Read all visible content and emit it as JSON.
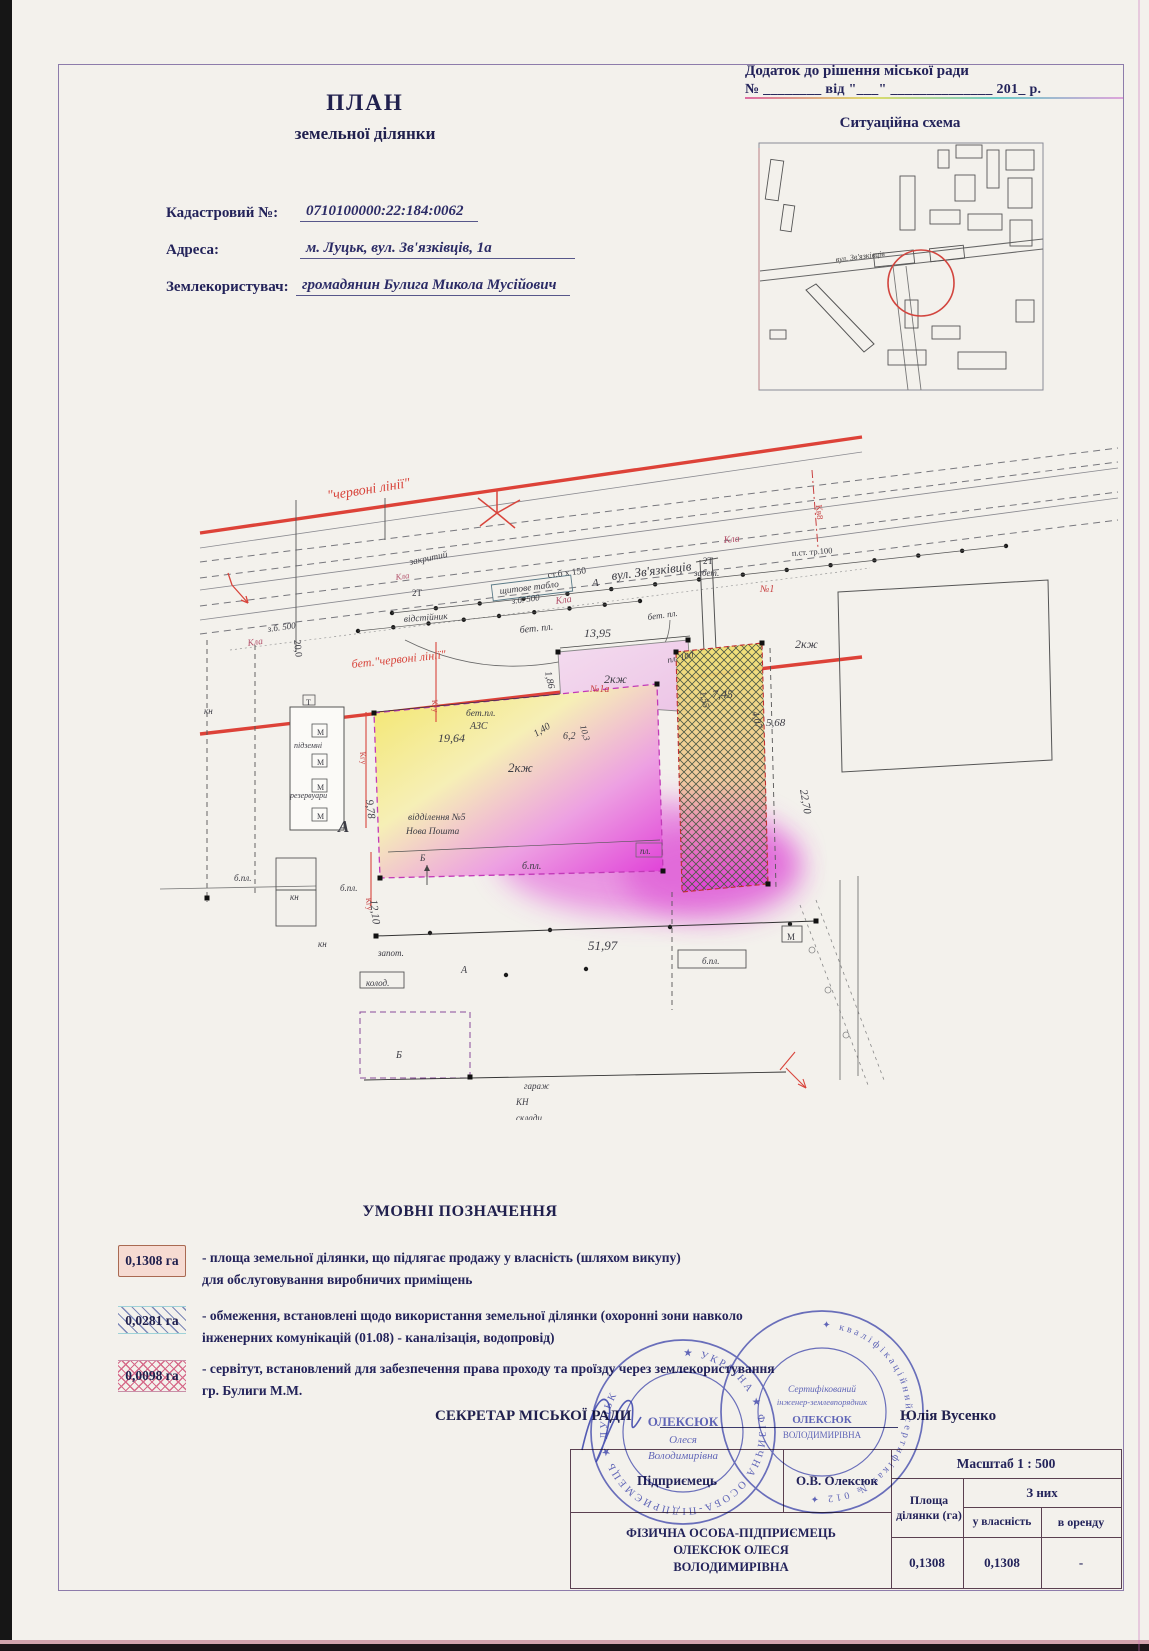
{
  "colors": {
    "red_line": "#dd4238",
    "magenta": "#e03ed8",
    "yellow": "#f3e66a",
    "stamp_blue": "#4a52bc",
    "navy_text": "#23235a"
  },
  "header": {
    "line1": "Додаток до рішення міської ради",
    "line2": "№ ________ від \"___\" ______________ 201_ р."
  },
  "situation": {
    "title": "Ситуаційна схема",
    "street": "вул. Зв'язківців"
  },
  "doc_title": {
    "line1": "ПЛАН",
    "line2": "земельної ділянки"
  },
  "fields": [
    {
      "label": "Кадастровий №:",
      "value": "0710100000:22:184:0062"
    },
    {
      "label": "Адреса:",
      "value": "м. Луцьк, вул. Зв'язківців, 1а"
    },
    {
      "label": "Землекористувач:",
      "value": "громадянин Булига Микола  Мусійович"
    }
  ],
  "plan": {
    "labels": [
      {
        "t": "\"червоні лінії\"",
        "x": 328,
        "y": 500,
        "s": 14,
        "c": "#d8453c",
        "r": -9,
        "i": true
      },
      {
        "t": "бет.\"червоні лінії\"",
        "x": 352,
        "y": 668,
        "s": 12,
        "c": "#d8453c",
        "r": -6,
        "i": true
      },
      {
        "t": "А",
        "x": 592,
        "y": 586,
        "s": 11,
        "i": true
      },
      {
        "t": "вул.  Зв'язківців",
        "x": 612,
        "y": 580,
        "s": 13,
        "r": -7,
        "i": true
      },
      {
        "t": "з.б. 500",
        "x": 268,
        "y": 632,
        "s": 9,
        "r": -8,
        "i": true
      },
      {
        "t": "Кла",
        "x": 248,
        "y": 646,
        "s": 9.5,
        "c": "#b2506a",
        "r": -8,
        "i": true
      },
      {
        "t": "з.б. 500",
        "x": 512,
        "y": 604,
        "s": 9,
        "r": -8,
        "i": true
      },
      {
        "t": "Кла",
        "x": 556,
        "y": 604,
        "s": 10,
        "c": "#b2506a",
        "r": -8,
        "i": true
      },
      {
        "t": "Кла",
        "x": 724,
        "y": 543,
        "s": 10,
        "c": "#b2506a",
        "r": -6,
        "i": true
      },
      {
        "t": "ст.б х 150",
        "x": 548,
        "y": 578,
        "s": 9.5,
        "r": -7
      },
      {
        "t": "закритий",
        "x": 410,
        "y": 565,
        "s": 9.5,
        "r": -12,
        "i": true
      },
      {
        "t": "Кла",
        "x": 396,
        "y": 580,
        "s": 8.5,
        "c": "#b2506a",
        "r": -8,
        "i": true
      },
      {
        "t": "2Т",
        "x": 412,
        "y": 596,
        "s": 9
      },
      {
        "t": "2Т",
        "x": 703,
        "y": 564,
        "s": 9
      },
      {
        "t": "забет.",
        "x": 694,
        "y": 576,
        "s": 9,
        "i": true
      },
      {
        "t": "щитове табло",
        "x": 500,
        "y": 594,
        "s": 9.5,
        "r": -7,
        "i": true
      },
      {
        "t": "відстійник",
        "x": 404,
        "y": 622,
        "s": 9.5,
        "r": -4,
        "i": true
      },
      {
        "t": "п.ст. тр.100",
        "x": 792,
        "y": 556,
        "s": 8.5,
        "r": -4
      },
      {
        "t": "№1",
        "x": 760,
        "y": 592,
        "s": 10,
        "c": "#c84040",
        "i": true
      },
      {
        "t": "Кв8",
        "x": 816,
        "y": 505,
        "s": 9,
        "c": "#c84040",
        "r": 85
      },
      {
        "t": "бет. пл.",
        "x": 520,
        "y": 633,
        "s": 10,
        "r": -6,
        "i": true
      },
      {
        "t": "бет. пл.",
        "x": 648,
        "y": 620,
        "s": 9,
        "r": -8,
        "i": true
      },
      {
        "t": "2кж",
        "x": 795,
        "y": 648,
        "s": 12,
        "i": true
      },
      {
        "t": "пл. 100",
        "x": 668,
        "y": 663,
        "s": 9,
        "r": -12,
        "i": true
      },
      {
        "t": "13,95",
        "x": 584,
        "y": 637,
        "s": 12,
        "i": true
      },
      {
        "t": "1,86",
        "x": 545,
        "y": 672,
        "s": 10,
        "r": 78,
        "i": true
      },
      {
        "t": "№1а",
        "x": 590,
        "y": 692,
        "s": 10,
        "c": "#c84040",
        "i": true
      },
      {
        "t": "2кж",
        "x": 604,
        "y": 683,
        "s": 12,
        "i": true
      },
      {
        "t": "7,45",
        "x": 712,
        "y": 698,
        "s": 12,
        "i": true
      },
      {
        "t": "1,55",
        "x": 700,
        "y": 692,
        "s": 9.5,
        "r": 78,
        "i": true
      },
      {
        "t": "4,07",
        "x": 752,
        "y": 712,
        "s": 10,
        "r": 76,
        "i": true
      },
      {
        "t": "5,68",
        "x": 766,
        "y": 726,
        "s": 11,
        "i": true
      },
      {
        "t": "10,3",
        "x": 580,
        "y": 726,
        "s": 9,
        "r": 74,
        "i": true
      },
      {
        "t": "1,40",
        "x": 536,
        "y": 737,
        "s": 10,
        "r": -32,
        "i": true
      },
      {
        "t": "6,2",
        "x": 563,
        "y": 739,
        "s": 10,
        "i": true
      },
      {
        "t": "19,64",
        "x": 438,
        "y": 742,
        "s": 12,
        "i": true
      },
      {
        "t": "бет.пл.",
        "x": 466,
        "y": 716,
        "s": 9.5,
        "i": true
      },
      {
        "t": "АЗС",
        "x": 470,
        "y": 729,
        "s": 10,
        "i": true
      },
      {
        "t": "2кж",
        "x": 508,
        "y": 772,
        "s": 13,
        "i": true
      },
      {
        "t": "9,78",
        "x": 366,
        "y": 800,
        "s": 11,
        "r": 83,
        "i": true
      },
      {
        "t": "12,10",
        "x": 370,
        "y": 900,
        "s": 11,
        "r": 83,
        "i": true
      },
      {
        "t": "відділення №5",
        "x": 408,
        "y": 820,
        "s": 9.5,
        "i": true
      },
      {
        "t": "Нова Пошта",
        "x": 406,
        "y": 834,
        "s": 9.5,
        "i": true
      },
      {
        "t": "Б",
        "x": 420,
        "y": 861,
        "s": 9,
        "i": true
      },
      {
        "t": "б.пл.",
        "x": 522,
        "y": 869,
        "s": 10,
        "i": true
      },
      {
        "t": "пл.",
        "x": 640,
        "y": 854,
        "s": 9,
        "i": true
      },
      {
        "t": "22,70",
        "x": 800,
        "y": 790,
        "s": 11,
        "r": 80,
        "i": true
      },
      {
        "t": "підземні",
        "x": 294,
        "y": 748,
        "s": 8,
        "i": true
      },
      {
        "t": "резервуари",
        "x": 290,
        "y": 798,
        "s": 8,
        "i": true
      },
      {
        "t": "А",
        "x": 338,
        "y": 832,
        "s": 17,
        "b": true,
        "i": true
      },
      {
        "t": "Т",
        "x": 306,
        "y": 705,
        "s": 8
      },
      {
        "t": "кн",
        "x": 204,
        "y": 714,
        "s": 9,
        "i": true
      },
      {
        "t": "кн",
        "x": 290,
        "y": 900,
        "s": 9,
        "i": true
      },
      {
        "t": "кн",
        "x": 318,
        "y": 947,
        "s": 9,
        "i": true
      },
      {
        "t": "б.пл.",
        "x": 234,
        "y": 881,
        "s": 9,
        "i": true
      },
      {
        "t": "б.пл.",
        "x": 340,
        "y": 891,
        "s": 9,
        "i": true
      },
      {
        "t": "Кгу",
        "x": 360,
        "y": 752,
        "s": 8,
        "c": "#c84040",
        "r": 84
      },
      {
        "t": "Кгу",
        "x": 432,
        "y": 700,
        "s": 8,
        "c": "#c84040",
        "r": 84
      },
      {
        "t": "Кгу",
        "x": 366,
        "y": 898,
        "s": 8,
        "c": "#c84040",
        "r": 84
      },
      {
        "t": "запот.",
        "x": 378,
        "y": 956,
        "s": 9,
        "i": true
      },
      {
        "t": "колод.",
        "x": 366,
        "y": 986,
        "s": 9,
        "i": true
      },
      {
        "t": "Б",
        "x": 396,
        "y": 1058,
        "s": 10,
        "i": true
      },
      {
        "t": "51,97",
        "x": 588,
        "y": 950,
        "s": 13,
        "i": true
      },
      {
        "t": "А",
        "x": 461,
        "y": 973,
        "s": 10,
        "i": true
      },
      {
        "t": "гараж",
        "x": 524,
        "y": 1089,
        "s": 9,
        "i": true
      },
      {
        "t": "КН",
        "x": 516,
        "y": 1105,
        "s": 9,
        "i": true
      },
      {
        "t": "склади",
        "x": 516,
        "y": 1121,
        "s": 9,
        "i": true
      },
      {
        "t": "б.пл.",
        "x": 702,
        "y": 964,
        "s": 9,
        "i": true
      },
      {
        "t": "М",
        "x": 787,
        "y": 940,
        "s": 9
      },
      {
        "t": "20,0",
        "x": 294,
        "y": 640,
        "s": 10,
        "r": 84
      },
      {
        "t": "М",
        "x": 317,
        "y": 735,
        "s": 8
      },
      {
        "t": "М",
        "x": 317,
        "y": 765,
        "s": 8
      },
      {
        "t": "М",
        "x": 317,
        "y": 790,
        "s": 8
      },
      {
        "t": "М",
        "x": 317,
        "y": 819,
        "s": 8
      }
    ]
  },
  "legend": {
    "title": "УМОВНІ ПОЗНАЧЕННЯ",
    "items": [
      {
        "value": "0,1308 га",
        "desc1": "- площа земельної ділянки, що підлягає продажу у власність (шляхом викупу)",
        "desc2": "для обслуговування виробничих приміщень"
      },
      {
        "value": "0,0281 га",
        "desc1": "- обмеження, встановлені щодо використання земельної ділянки (охоронні зони навколо",
        "desc2": "інженерних комунікацій (01.08) -  каналізація, водопровід)"
      },
      {
        "value": "0,0098 га",
        "desc1": "- сервітут, встановлений для забезпечення права проходу та проїзду через землекористування",
        "desc2": "гр. Булиги М.М."
      }
    ]
  },
  "secretary": {
    "label": "СЕКРЕТАР МІСЬКОЇ РАДИ",
    "name": "Юлія Вусенко"
  },
  "table": {
    "scale": "Масштаб 1 : 500",
    "entrepreneur_label": "Підприємець",
    "entrepreneur_name": "О.В. Олексюк",
    "fop_line1": "ФІЗИЧНА ОСОБА-ПІДПРИЄМЕЦЬ",
    "fop_line2": "ОЛЕКСЮК ОЛЕСЯ",
    "fop_line3": "ВОЛОДИМИРІВНА",
    "col_area": "Площа ділянки (га)",
    "col_group": "З них",
    "col_own": "у власність",
    "col_rent": "в оренду",
    "val_area": "0,1308",
    "val_own": "0,1308",
    "val_rent": "-"
  },
  "stamps": {
    "s1_ring": "★ УКРАЇНА ★ ФІЗИЧНА ОСОБА-ПІДПРИЄМЕЦЬ ★ ЛУЦЬК",
    "s1_c1": "ОЛЕКСЮК",
    "s1_c2": "Олеся",
    "s1_c3": "Володимирівна",
    "s2_ring": "✦ кваліфікаційний сертифікат № 012 ✦",
    "s2_c1": "Сертифікований",
    "s2_c2": "інженер-землевпорядник",
    "s2_c3": "ОЛЕКСЮК",
    "s2_c4": "ВОЛОДИМИРІВНА"
  }
}
